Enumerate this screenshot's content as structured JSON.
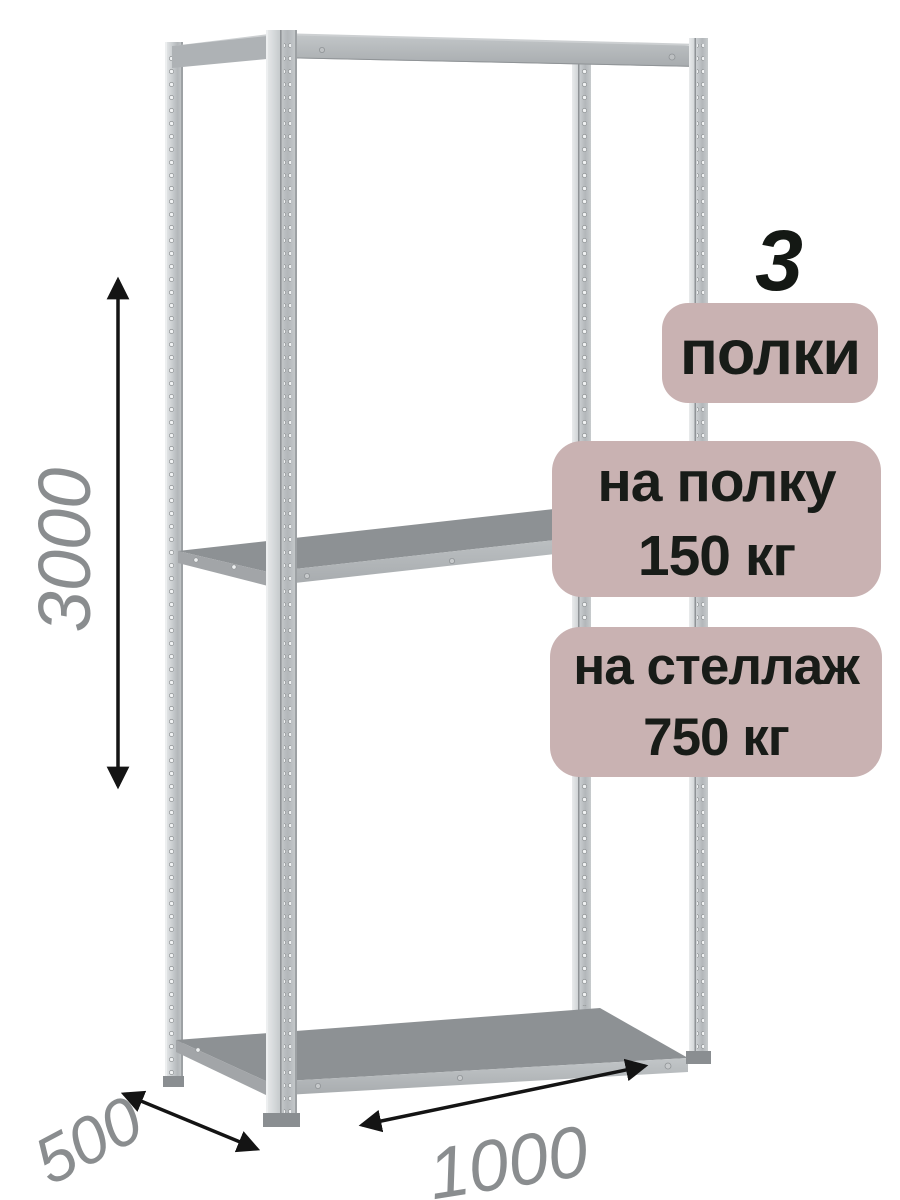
{
  "product_annotations": {
    "shelf_count": "3",
    "shelf_count_label": "полки",
    "per_shelf_load_line1": "на полку",
    "per_shelf_load_line2": "150 кг",
    "per_rack_load_line1": "на стеллаж",
    "per_rack_load_line2": "750 кг"
  },
  "dimensions": {
    "height": "3000",
    "depth": "500",
    "width": "1000"
  },
  "colors": {
    "badge_background": "#c9b2b2",
    "badge_text": "#181c18",
    "dimension_text": "#8a8d8f",
    "arrow": "#141414",
    "metal_light": "#d9dcde",
    "metal_mid": "#b7babd",
    "shelf_surface": "#8d9194"
  }
}
